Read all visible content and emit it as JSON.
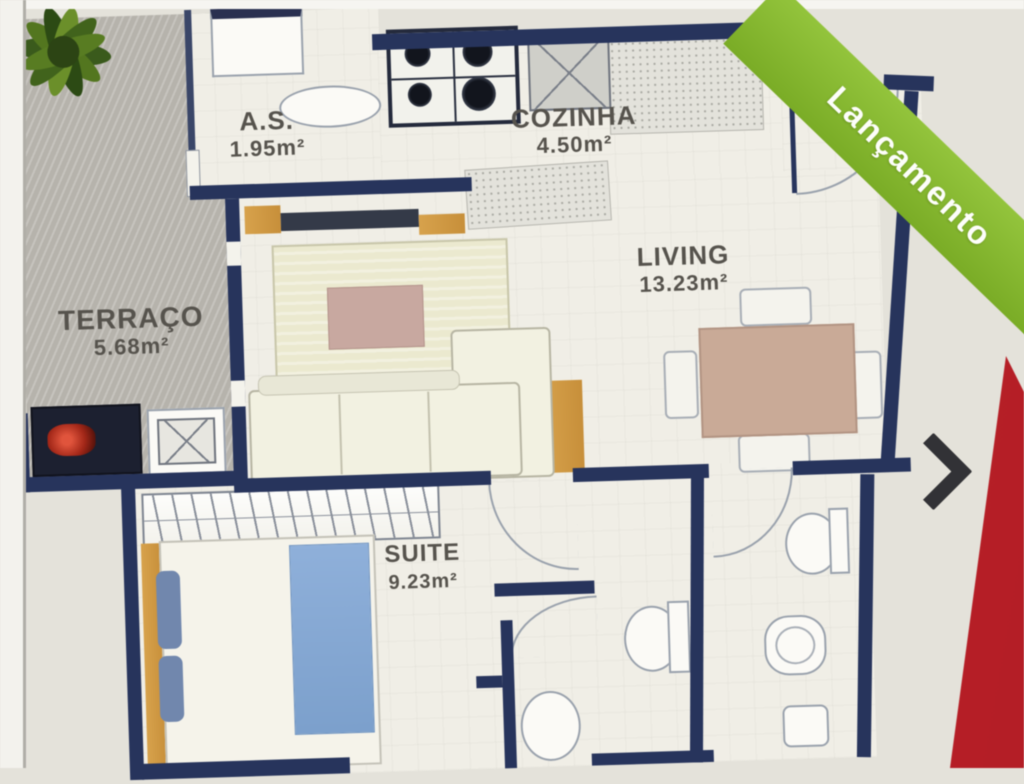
{
  "banner": {
    "label": "Lançamento",
    "color": "#86ba2f"
  },
  "gallery": {
    "next_icon": "chevron-right",
    "stripe_color": "#c4242c"
  },
  "rooms": {
    "terraco": {
      "name": "TERRAÇO",
      "area": "5.68m²"
    },
    "as": {
      "name": "A.S.",
      "area": "1.95m²"
    },
    "cozinha": {
      "name": "COZINHA",
      "area": "4.50m²"
    },
    "living": {
      "name": "LIVING",
      "area": "13.23m²"
    },
    "suite": {
      "name": "SUITE",
      "area": "9.23m²"
    }
  },
  "palette": {
    "wall_navy": "#27345c",
    "wood": "#d19a44",
    "terrace_gray": "#b6b3ac",
    "bed_blue": "#84a7d2",
    "rug_green": "#ebe9cf",
    "table_tan": "#c9aa97",
    "plant_green": "#4a6b1d",
    "red_stripe": "#c4242c",
    "ribbon_green": "#86ba2f",
    "chevron_dark": "#323236"
  }
}
